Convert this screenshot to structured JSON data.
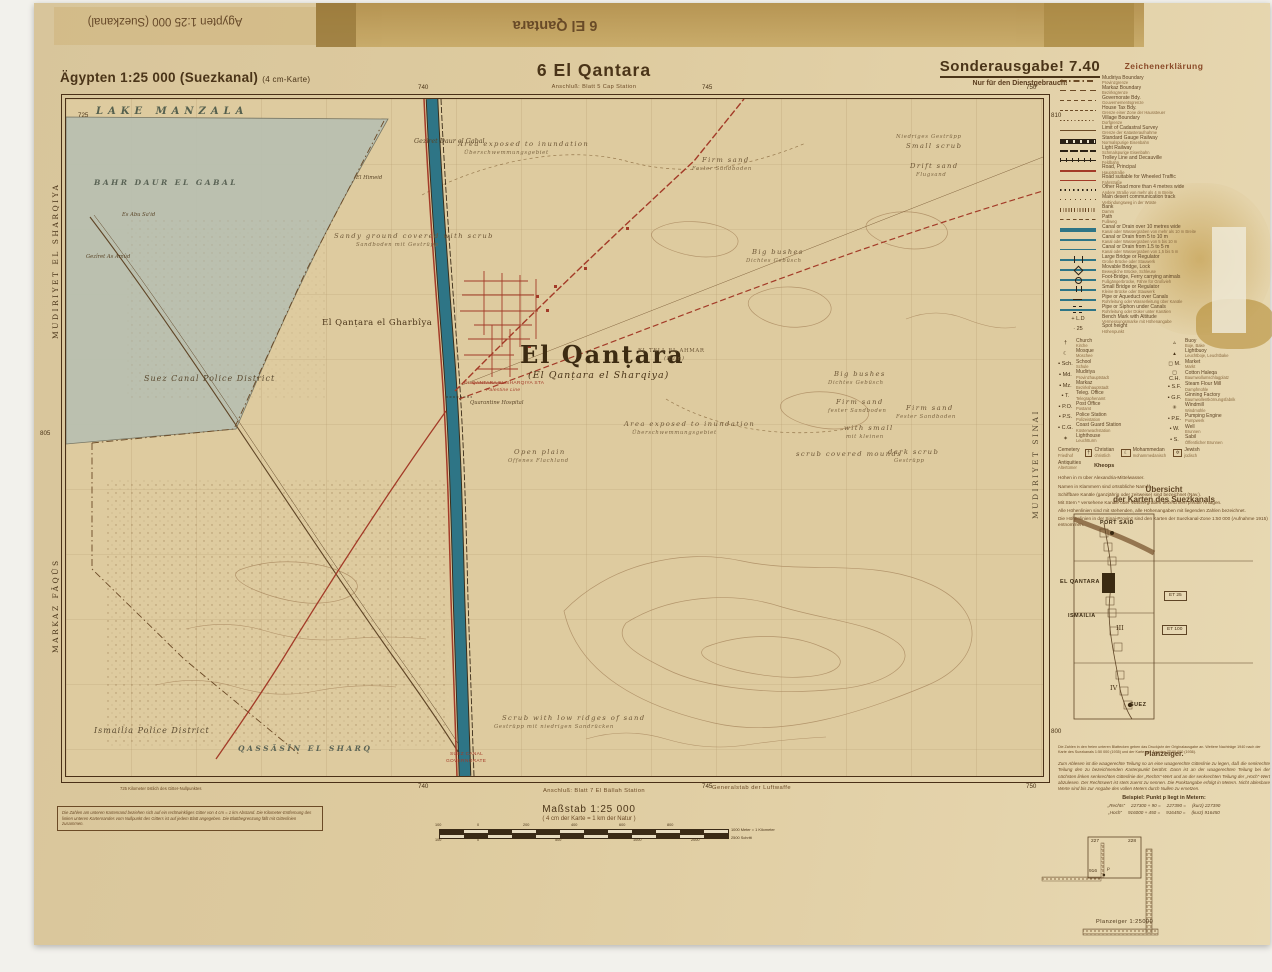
{
  "colors": {
    "paper": "#decb9f",
    "accent_red": "#a33b28",
    "canal_teal": "#2e7586",
    "ink": "#4a3418",
    "lake": "#b9c0b1"
  },
  "masthead": {
    "series": "Ägypten 1:25 000 (Suezkanal)",
    "series_note": "(4 cm-Karte)",
    "sheet_title": "6  El Qantara",
    "adjoin_top": "Anschluß: Blatt 5 Cap Station",
    "edition": "Sonderausgabe! 7.40",
    "restriction": "Nur für den Dienstgebrauch!"
  },
  "flipped": {
    "series": "Ägypten 1:25 000 (Suezkanal)",
    "sheet": "6 El Qantara"
  },
  "footer": {
    "adjoin_bottom": "Anschluß: Blatt 7 El Bällah Station",
    "publisher": "Generalstab der Luftwaffe",
    "corner_note": "725 Kilometer östlich des Gitter-Nullpunktes",
    "box_note": "Die Zahlen am unteren Kartenrand beziehen sich auf ein rechtwinkliges Gitter von 4 cm = 1 km Abstand. Die Kilometer-Entfernung des linken unteren Kartenrandes vom Nullpunkt des Gitters ist auf jedem Blatt angegeben. Die Blattbegrenzung fällt mit Gitterlinien zusammen."
  },
  "scalebar": {
    "heading": "Maßstab 1:25 000",
    "note": "( 4 cm der Karte = 1 km der Natur )",
    "cap_top": "1000 Meter = 1 Kilometer",
    "cap_bottom": "2500 Schritt",
    "ticks": [
      {
        "t": "100",
        "x": -4,
        "c": "tt"
      },
      {
        "t": "0",
        "x": 38,
        "c": "tt"
      },
      {
        "t": "200",
        "x": 84,
        "c": "tt"
      },
      {
        "t": "400",
        "x": 132,
        "c": "tt"
      },
      {
        "t": "600",
        "x": 180,
        "c": "tt"
      },
      {
        "t": "800",
        "x": 228,
        "c": "tt"
      },
      {
        "t": "100",
        "x": -4,
        "c": "tb"
      },
      {
        "t": "0",
        "x": 38,
        "c": "tb"
      },
      {
        "t": "500",
        "x": 116,
        "c": "tb"
      },
      {
        "t": "1000",
        "x": 194,
        "c": "tb"
      },
      {
        "t": "2000",
        "x": 252,
        "c": "tb"
      }
    ]
  },
  "grid_numbers": [
    {
      "t": "725",
      "x": 44,
      "y": 110
    },
    {
      "t": "740",
      "x": 384,
      "y": 82
    },
    {
      "t": "745",
      "x": 668,
      "y": 82
    },
    {
      "t": "750",
      "x": 992,
      "y": 82
    },
    {
      "t": "740",
      "x": 384,
      "y": 781
    },
    {
      "t": "745",
      "x": 668,
      "y": 781
    },
    {
      "t": "750",
      "x": 992,
      "y": 781
    },
    {
      "t": "805",
      "x": 6,
      "y": 428
    },
    {
      "t": "810",
      "x": 1017,
      "y": 110
    },
    {
      "t": "800",
      "x": 1017,
      "y": 726
    }
  ],
  "edge_labels": [
    {
      "t": "MUDIRIYET EL SHARQIYA",
      "x": 18,
      "y": 336,
      "rot": -90
    },
    {
      "t": "MARKAZ FÂQÛS",
      "x": 18,
      "y": 650,
      "rot": -90
    }
  ],
  "map": {
    "labels": [
      {
        "t": "LAKE MANZALA",
        "x": 30,
        "y": 8,
        "c": "water-caps"
      },
      {
        "t": "BAHR DAUR EL GABAL",
        "x": 28,
        "y": 80,
        "c": "water-caps sm"
      },
      {
        "t": "Gezîret Daur el Gabal",
        "x": 348,
        "y": 39,
        "c": "place"
      },
      {
        "t": "El Himeid",
        "x": 290,
        "y": 77,
        "c": "place tiny"
      },
      {
        "t": "Es Abu Sa'id",
        "x": 56,
        "y": 114,
        "c": "place tiny"
      },
      {
        "t": "Gezîret As Amûd",
        "x": 20,
        "y": 156,
        "c": "place tiny"
      },
      {
        "t": "Sandy ground covered with scrub",
        "x": 268,
        "y": 134,
        "c": "terrain"
      },
      {
        "t": "Sandboden mit Gestrüpp",
        "x": 290,
        "y": 144,
        "c": "terrain de"
      },
      {
        "t": "Area exposed to inundation",
        "x": 392,
        "y": 42,
        "c": "terrain"
      },
      {
        "t": "Überschwemmungsgebiet",
        "x": 398,
        "y": 52,
        "c": "terrain de"
      },
      {
        "t": "Firm sand",
        "x": 636,
        "y": 58,
        "c": "terrain"
      },
      {
        "t": "Fester Sandboden",
        "x": 626,
        "y": 68,
        "c": "terrain de"
      },
      {
        "t": "Niedriges Gestrüpp",
        "x": 830,
        "y": 36,
        "c": "terrain de"
      },
      {
        "t": "Small scrub",
        "x": 840,
        "y": 44,
        "c": "terrain"
      },
      {
        "t": "Drift sand",
        "x": 844,
        "y": 64,
        "c": "terrain"
      },
      {
        "t": "Flugsand",
        "x": 850,
        "y": 74,
        "c": "terrain de"
      },
      {
        "t": "Big bushes",
        "x": 686,
        "y": 150,
        "c": "terrain"
      },
      {
        "t": "Dichtes Gebüsch",
        "x": 680,
        "y": 160,
        "c": "terrain de"
      },
      {
        "t": "El Qanṭara el Gharbîya",
        "x": 256,
        "y": 220,
        "c": "town2"
      },
      {
        "t": "Suez Canal Police District",
        "x": 78,
        "y": 276,
        "c": "district"
      },
      {
        "t": "El Qanṭara",
        "x": 454,
        "y": 244,
        "c": "town-big"
      },
      {
        "t": "(El Qanṭara el Sharqiya)",
        "x": 462,
        "y": 272,
        "c": "town-sub"
      },
      {
        "t": "EL TELL EL AHMAR",
        "x": 572,
        "y": 250,
        "c": "ruin"
      },
      {
        "t": "(Ruin)",
        "x": 598,
        "y": 258,
        "c": "ruin sub2"
      },
      {
        "t": "EL QANTARA EL SHARQIYA STA",
        "x": 398,
        "y": 283,
        "c": "red-tiny"
      },
      {
        "t": "Palestine Line",
        "x": 420,
        "y": 290,
        "c": "red-tiny it"
      },
      {
        "t": "Quarantine Hospital",
        "x": 404,
        "y": 302,
        "c": "place tiny"
      },
      {
        "t": "Area exposed to inundation",
        "x": 558,
        "y": 322,
        "c": "terrain"
      },
      {
        "t": "Überschwemmungsgebiet",
        "x": 566,
        "y": 332,
        "c": "terrain de"
      },
      {
        "t": "Big bushes",
        "x": 768,
        "y": 272,
        "c": "terrain"
      },
      {
        "t": "Dichtes Gebüsch",
        "x": 762,
        "y": 282,
        "c": "terrain de"
      },
      {
        "t": "Firm sand",
        "x": 770,
        "y": 300,
        "c": "terrain"
      },
      {
        "t": "fester Sandboden",
        "x": 762,
        "y": 310,
        "c": "terrain de"
      },
      {
        "t": "with small",
        "x": 778,
        "y": 326,
        "c": "terrain"
      },
      {
        "t": "mit kleinen",
        "x": 780,
        "y": 336,
        "c": "terrain de"
      },
      {
        "t": "scrub covered mounds",
        "x": 730,
        "y": 352,
        "c": "terrain"
      },
      {
        "t": "Firm sand",
        "x": 840,
        "y": 306,
        "c": "terrain"
      },
      {
        "t": "Fester Sandboden",
        "x": 830,
        "y": 316,
        "c": "terrain de"
      },
      {
        "t": "dark scrub",
        "x": 822,
        "y": 350,
        "c": "terrain"
      },
      {
        "t": "Gestrüpp",
        "x": 828,
        "y": 360,
        "c": "terrain de"
      },
      {
        "t": "Open plain",
        "x": 448,
        "y": 350,
        "c": "terrain"
      },
      {
        "t": "Offenes Flachland",
        "x": 442,
        "y": 360,
        "c": "terrain de"
      },
      {
        "t": "Scrub with low ridges of sand",
        "x": 436,
        "y": 616,
        "c": "terrain"
      },
      {
        "t": "Gestrüpp mit niedrigen Sandrücken",
        "x": 428,
        "y": 626,
        "c": "terrain de"
      },
      {
        "t": "Ismailia Police District",
        "x": 28,
        "y": 628,
        "c": "district"
      },
      {
        "t": "QASSÂSÎN EL SHARQ",
        "x": 172,
        "y": 646,
        "c": "water-caps sm"
      },
      {
        "t": "SUEZ CANAL",
        "x": 384,
        "y": 654,
        "c": "red-tiny"
      },
      {
        "t": "GOVERNORATE",
        "x": 380,
        "y": 661,
        "c": "red-tiny"
      },
      {
        "t": "MUDIRIYET SINAI",
        "x": 966,
        "y": 420,
        "c": "district caps",
        "rot": -90
      }
    ]
  },
  "legend": {
    "title": "Zeichenerklärung",
    "rows": [
      {
        "sym": "dashdot",
        "en": "Mudiriya Boundary",
        "de": "Provinzgrenze"
      },
      {
        "sym": "dash6",
        "en": "Markaz Boundary",
        "de": "Bezirksgrenze"
      },
      {
        "sym": "dash4",
        "en": "Governorate Bdy.",
        "de": "Gouvernementsgrenze"
      },
      {
        "sym": "dash3",
        "en": "House Tax Bdy.",
        "de": "Grenze einer Zone der Haussteuer"
      },
      {
        "sym": "dots",
        "en": "Village Boundary",
        "de": "Dorfgrenze"
      },
      {
        "sym": "solid",
        "en": "Limit of Cadastral Survey",
        "de": "Grenze der Katasteraufnahme"
      },
      {
        "sym": "rail",
        "en": "Standard Gauge Railway",
        "de": "Normalspurige Eisenbahn"
      },
      {
        "sym": "rail2",
        "en": "Light Railway",
        "de": "Schmalspurige Eisenbahn"
      },
      {
        "sym": "trolley",
        "en": "Trolley Line and Decauville",
        "de": "Feldbahn"
      },
      {
        "sym": "roadmain",
        "en": "Road, Principal",
        "de": "Hauptstraße"
      },
      {
        "sym": "road",
        "en": "Road suitable for Wheeled Traffic",
        "de": "Fahrstraße"
      },
      {
        "sym": "dots2",
        "en": "Other Road more than 4 metres wide",
        "de": "Andere Straße von mehr als 4 m Breite"
      },
      {
        "sym": "track",
        "en": "Main desert communication track",
        "de": "Verbindungsweg in der Wüste"
      },
      {
        "sym": "bank",
        "en": "Bank",
        "de": "Damm"
      },
      {
        "sym": "path",
        "en": "Path",
        "de": "Fußweg"
      },
      {
        "sym": "canal10",
        "en": "Canal or Drain over 10 metres wide",
        "de": "Kanal oder Wassergraben von mehr als 10 m Breite"
      },
      {
        "sym": "canal5",
        "en": "Canal or Drain from 5 to 10 m",
        "de": "Kanal oder Wassergraben von 5 bis 10 m"
      },
      {
        "sym": "canal1",
        "en": "Canal or Drain from 1.5 to 5 m",
        "de": "Kanal oder Wassergraben von 1,5 bis 5 m"
      },
      {
        "sym": "brlarge",
        "en": "Large Bridge or Regulator",
        "de": "Große Brücke oder Stauwerk"
      },
      {
        "sym": "brmove",
        "en": "Movable Bridge, Lock",
        "de": "Bewegliche Brücke, Schleuse"
      },
      {
        "sym": "brfoot",
        "en": "Foot-Bridge, Ferry carrying animals",
        "de": "Fußgängerbrücke, Fähre für Großvieh"
      },
      {
        "sym": "brsmall",
        "en": "Small Bridge or Regulator",
        "de": "Kleine Brücke oder Stauwerk"
      },
      {
        "sym": "pipeover",
        "en": "Pipe or Aqueduct over Canals",
        "de": "Rohrleitung oder Wasserleitung über Kanäle"
      },
      {
        "sym": "pipeunder",
        "en": "Pipe or Siphon under Canals",
        "de": "Rohrleitung oder Düker unter Kanälen"
      },
      {
        "st": "+ L.D",
        "en": "Bench Mark with Altitude",
        "de": "Vermessungsmarke mit Höhenangabe"
      },
      {
        "st": "· 25",
        "en": "Spot height",
        "de": "Höhenpunkt"
      }
    ],
    "table_left": [
      {
        "g": "†",
        "en": "Church",
        "de": "Kirche"
      },
      {
        "g": "☾",
        "en": "Mosque",
        "de": "Moschee"
      },
      {
        "g": "▪ Sch.",
        "en": "School",
        "de": "Schule"
      },
      {
        "g": "▪ Md.",
        "en": "Mudiriya",
        "de": "Provinzhauptstadt"
      },
      {
        "g": "▪ Mz.",
        "en": "Markaz",
        "de": "Bezirkshauptstadt"
      },
      {
        "g": "▪ T.",
        "en": "Teleg. Office",
        "de": "Telegraphenamt"
      },
      {
        "g": "▪ P.O.",
        "en": "Post Office",
        "de": "Postamt"
      },
      {
        "g": "▪ P.S.",
        "en": "Police Station",
        "de": "Polizeistation"
      },
      {
        "g": "▪ C.G.",
        "en": "Coast Guard Station",
        "de": "Küstenwachstation"
      },
      {
        "g": "✶",
        "en": "Lighthouse",
        "de": "Leuchtturm"
      }
    ],
    "table_right": [
      {
        "g": "▵",
        "en": "Buoy",
        "de": "Boje, Bake"
      },
      {
        "g": "▴",
        "en": "Lightbuoy",
        "de": "Leuchtboje, Leuchtbake"
      },
      {
        "g": "◻ M.",
        "en": "Market",
        "de": "Markt"
      },
      {
        "g": "◻ C.H.",
        "en": "Cotton Haleqa",
        "de": "Baumwollumschlagplatz"
      },
      {
        "g": "▪ S.F.",
        "en": "Steam Flour Mill",
        "de": "Dampfmühle"
      },
      {
        "g": "▪ G.F.",
        "en": "Ginning Factory",
        "de": "Baumwollentkörnungsfabrik"
      },
      {
        "g": "✳",
        "en": "Windmill",
        "de": "Windmühle"
      },
      {
        "g": "• P.E.",
        "en": "Pumping Engine",
        "de": "Pumpwerk"
      },
      {
        "g": "• W.",
        "en": "Well",
        "de": "Brunnen"
      },
      {
        "g": "• S.",
        "en": "Sabil",
        "de": "Öffentlicher Brunnen"
      }
    ],
    "cemetery": {
      "en": "Cemetery",
      "de": "Friedhof",
      "entries": [
        {
          "g": "†",
          "en": "Christian",
          "de": "christlich"
        },
        {
          "g": "☾",
          "en": "Mohammedan",
          "de": "mohammedanisch"
        },
        {
          "g": "✡",
          "en": "Jewish",
          "de": "jüdisch"
        }
      ]
    },
    "antiquities": {
      "en": "Antiquities",
      "de": "Altertümer",
      "example": "Kheops"
    },
    "notes": [
      "Höhen in m über Alexandria-Mittelwasser.",
      "Namen in Klammern sind ortsübliche Namen.",
      "Schiffbare Kanäle (ganzjährig oder zeitweise) sind bezeichnet (Nav.).",
      "Mit Stern * versehene Kanäle oder Wassergräben bezeichnen private Anlagen.",
      "Alle Höhenlinien sind mit stehenden, alle Höhenangaben mit liegenden Zahlen bezeichnet.",
      "Die Höhenlinien in der Sinai-Provinz sind den Karten der Suezkanal-Zone 1:50 000 (Aufnahme 1915) entnommen."
    ]
  },
  "uebersicht": {
    "title_1": "Übersicht",
    "title_2": "der Karten des Suezkanals",
    "labels": [
      {
        "t": "PORT SAID",
        "x": 42,
        "y": 12,
        "c": "ub"
      },
      {
        "t": "EL QANTARA",
        "x": 2,
        "y": 71,
        "c": "ub"
      },
      {
        "t": "ISMAILIA",
        "x": 10,
        "y": 105,
        "c": "ub"
      },
      {
        "t": "SUEZ",
        "x": 72,
        "y": 194,
        "c": "ub"
      },
      {
        "t": "III",
        "x": 58,
        "y": 116,
        "c": "un"
      },
      {
        "t": "IV",
        "x": 52,
        "y": 176,
        "c": "un"
      },
      {
        "t": "ET 25",
        "x": 106,
        "y": 82,
        "c": "ue"
      },
      {
        "t": "ET 100",
        "x": 104,
        "y": 116,
        "c": "ue"
      }
    ],
    "footnote": "Die Zahlen in den freien unteren Blattecken geben das Druckjahr der Originalausgabe an. Weitere Nachträge 1940 nach der Karte des Suezkanals 1:50 000 (1935) und der Karte von Ägypten 1:100 000 (1936)."
  },
  "planzeiger": {
    "title": "Planzeiger.",
    "body": "Zum Ablesen ist die waagerechte Teilung so an eine waagerechte Gitterlinie zu legen, daß die senkrechte Teilung den zu bezeichnenden Kartenpunkt berührt. Dann ist an der waagerechten Teilung bei der nächsten linken senkrechten Gitterlinie der „Rechts“-Wert und an der senkrechten Teilung der „Hoch“-Wert abzulesen. Der Rechtswert ist stets zuerst zu nennen. Die Punktangabe erfolgt in Metern. Nicht ablesbare Werte sind bis zur Angabe des vollen Meters durch Nullen zu ersetzen.",
    "example_title": "Beispiel: Punkt p liegt in Metern:",
    "example_rows": [
      {
        "a": "„Rechts“",
        "b": "227300 + 90 =",
        "c": "227390 =",
        "d": "(kurz) 227390"
      },
      {
        "a": "„Hoch“",
        "b": "916000 + 450 =",
        "c": "916450 =",
        "d": "(kurz) 916450"
      }
    ],
    "diagram": {
      "c1": "227",
      "c2": "228",
      "r1": "916",
      "p": "p",
      "caption": "Planzeiger 1:25000"
    }
  }
}
